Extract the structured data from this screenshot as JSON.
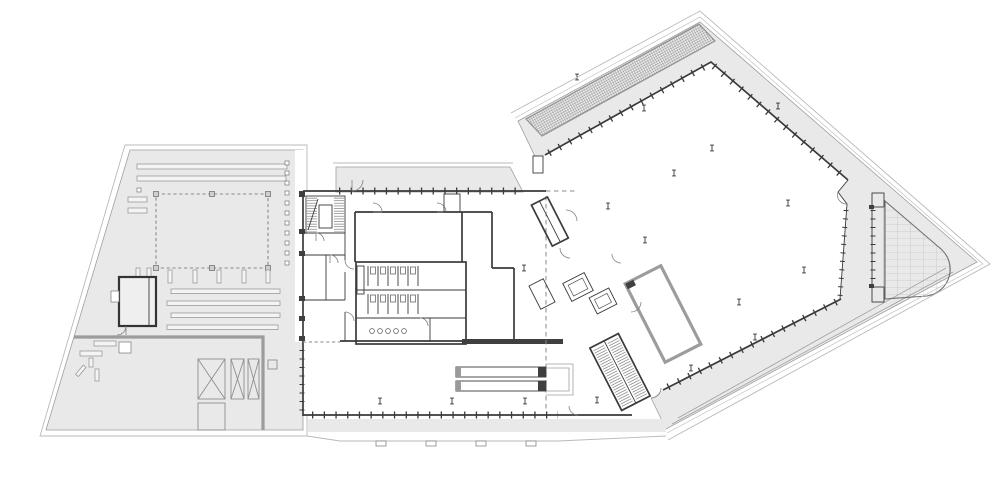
{
  "drawing": {
    "kind": "architectural-floor-plan",
    "labels_visible": "none",
    "orientation": "east-wing-rotated"
  },
  "colors": {
    "paper": "#ffffff",
    "site-gray": "#e9e9e9",
    "boundary": "#b9b9b9",
    "medium-gray": "#9f9f9f",
    "wall-dark": "#3a3a3a",
    "thick-wall-gray": "#9c9c9c",
    "hatch-line": "#4e4e4e",
    "paver-line": "#b7b7b7",
    "dash-gray": "#8a8a8a",
    "fixture-line": "#555555",
    "dark-fill": "#3f3f3f"
  },
  "zones": {
    "west_terrace": {
      "features": [
        "roof-strips",
        "skylight-dashed-outline",
        "service-room",
        "roof-hatch-x-boxes",
        "equipment-pads",
        "thick-parapet-line"
      ]
    },
    "core_building": {
      "features": [
        "north-terrace-band",
        "stair-elevator-core",
        "restroom-block",
        "escalator-pair",
        "curtain-wall-mullions",
        "column-markers",
        "south-terrace-band"
      ]
    },
    "east_hall": {
      "features": [
        "louver-grid-strip",
        "open-hall",
        "column-markers",
        "service-room",
        "rotated-stair-cores",
        "elevator-pair",
        "paver-terrace-rounded",
        "perimeter-terrace"
      ]
    }
  }
}
